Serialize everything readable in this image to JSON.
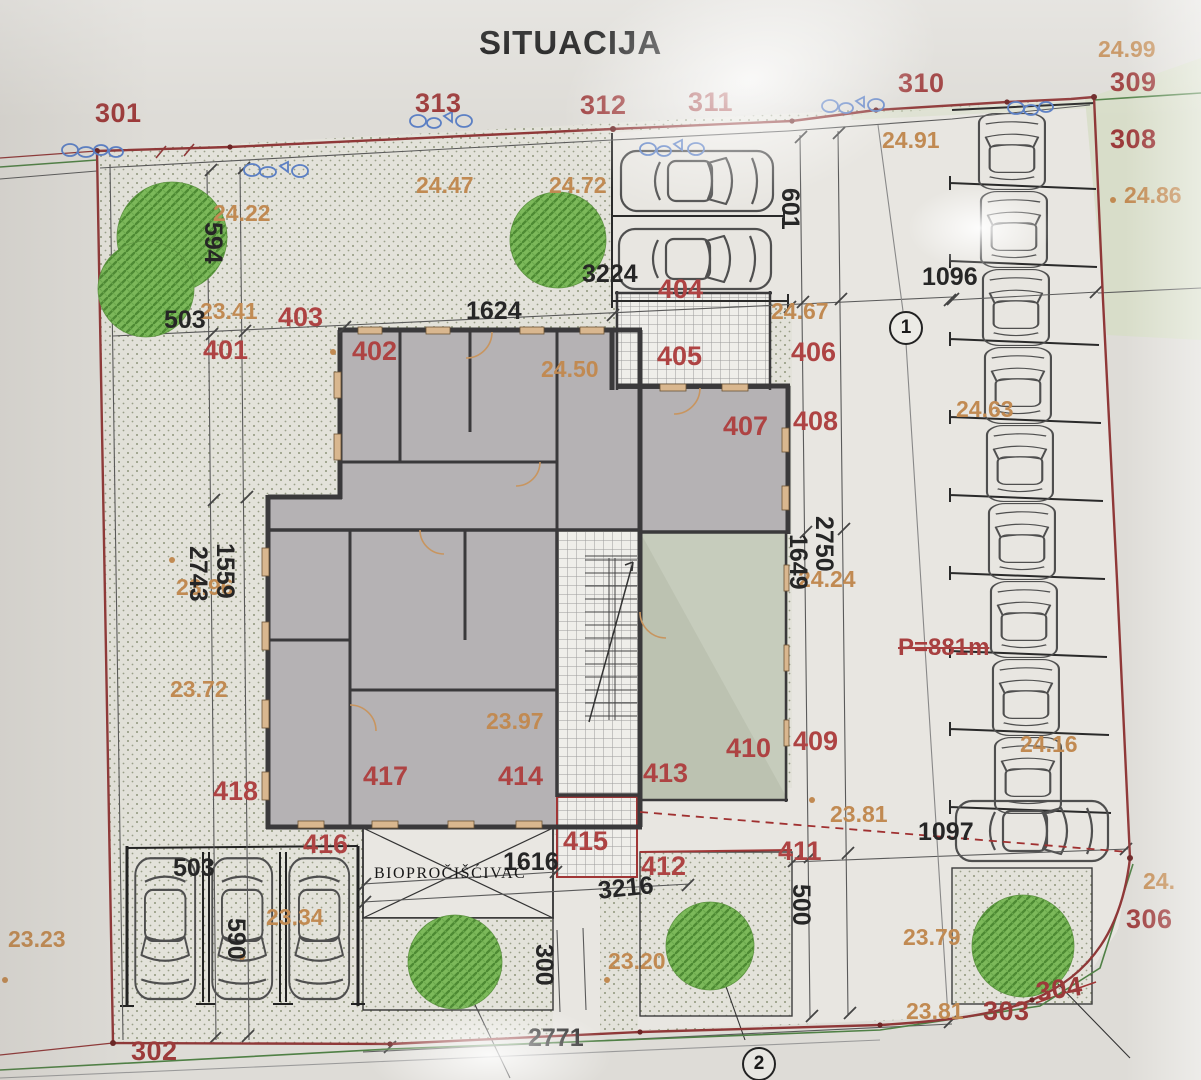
{
  "title": "SITUACIJA",
  "parcels": {
    "p301": "301",
    "p302": "302",
    "p303": "303",
    "p304": "304",
    "p306": "306",
    "p308": "308",
    "p309": "309",
    "p310": "310",
    "p311": "311",
    "p312": "312",
    "p313": "313"
  },
  "units": {
    "u401": "401",
    "u402": "402",
    "u403": "403",
    "u404": "404",
    "u405": "405",
    "u406": "406",
    "u407": "407",
    "u408": "408",
    "u409": "409",
    "u410": "410",
    "u411": "411",
    "u412": "412",
    "u413": "413",
    "u414": "414",
    "u415": "415",
    "u416": "416",
    "u417": "417",
    "u418": "418"
  },
  "elevations": {
    "e2499": "24.99",
    "e2491": "24.91",
    "e2486": "24.86",
    "e2472": "24.72",
    "e2447": "24.47",
    "e2422": "24.22",
    "e2450": "24.50",
    "e2467": "24.67",
    "e2463": "24.63",
    "e2424": "24.24",
    "e2416": "24.16",
    "e2397": "23.97",
    "e2396": "23.96",
    "e2372": "23.72",
    "e2341": "23.41",
    "e2334": "23.34",
    "e2381a": "23.81",
    "e2381b": "23.81",
    "e2379": "23.79",
    "e2323": "23.23",
    "e2320": "23.20",
    "e24cut": "24."
  },
  "dimensions": {
    "d594": "594",
    "d601": "601",
    "d1624": "1624",
    "d3224": "3224",
    "d1096": "1096",
    "d1097": "1097",
    "d2750": "2750",
    "d1649": "1649",
    "d1559": "1559",
    "d2743": "2743",
    "d503a": "503",
    "d503b": "503",
    "d590": "590",
    "d500": "500",
    "d300": "300",
    "d1616": "1616",
    "d3216": "3216",
    "d2771": "2771"
  },
  "annotations": {
    "bio": "BIOPROČIŠĆIVAČ",
    "area": "P=881m",
    "node1": "1",
    "node2": "2"
  },
  "colors": {
    "boundary": "#8f3838",
    "survey_green": "#4f8045",
    "elevation_text": "#c18a52",
    "parcel_text": "#9c3a3a",
    "dimension_text": "#262626",
    "tree": "#7cb95a",
    "scribble_blue": "#5b7fc4",
    "building_wall": "#3a393b",
    "building_fill": "#b5b2b4"
  }
}
